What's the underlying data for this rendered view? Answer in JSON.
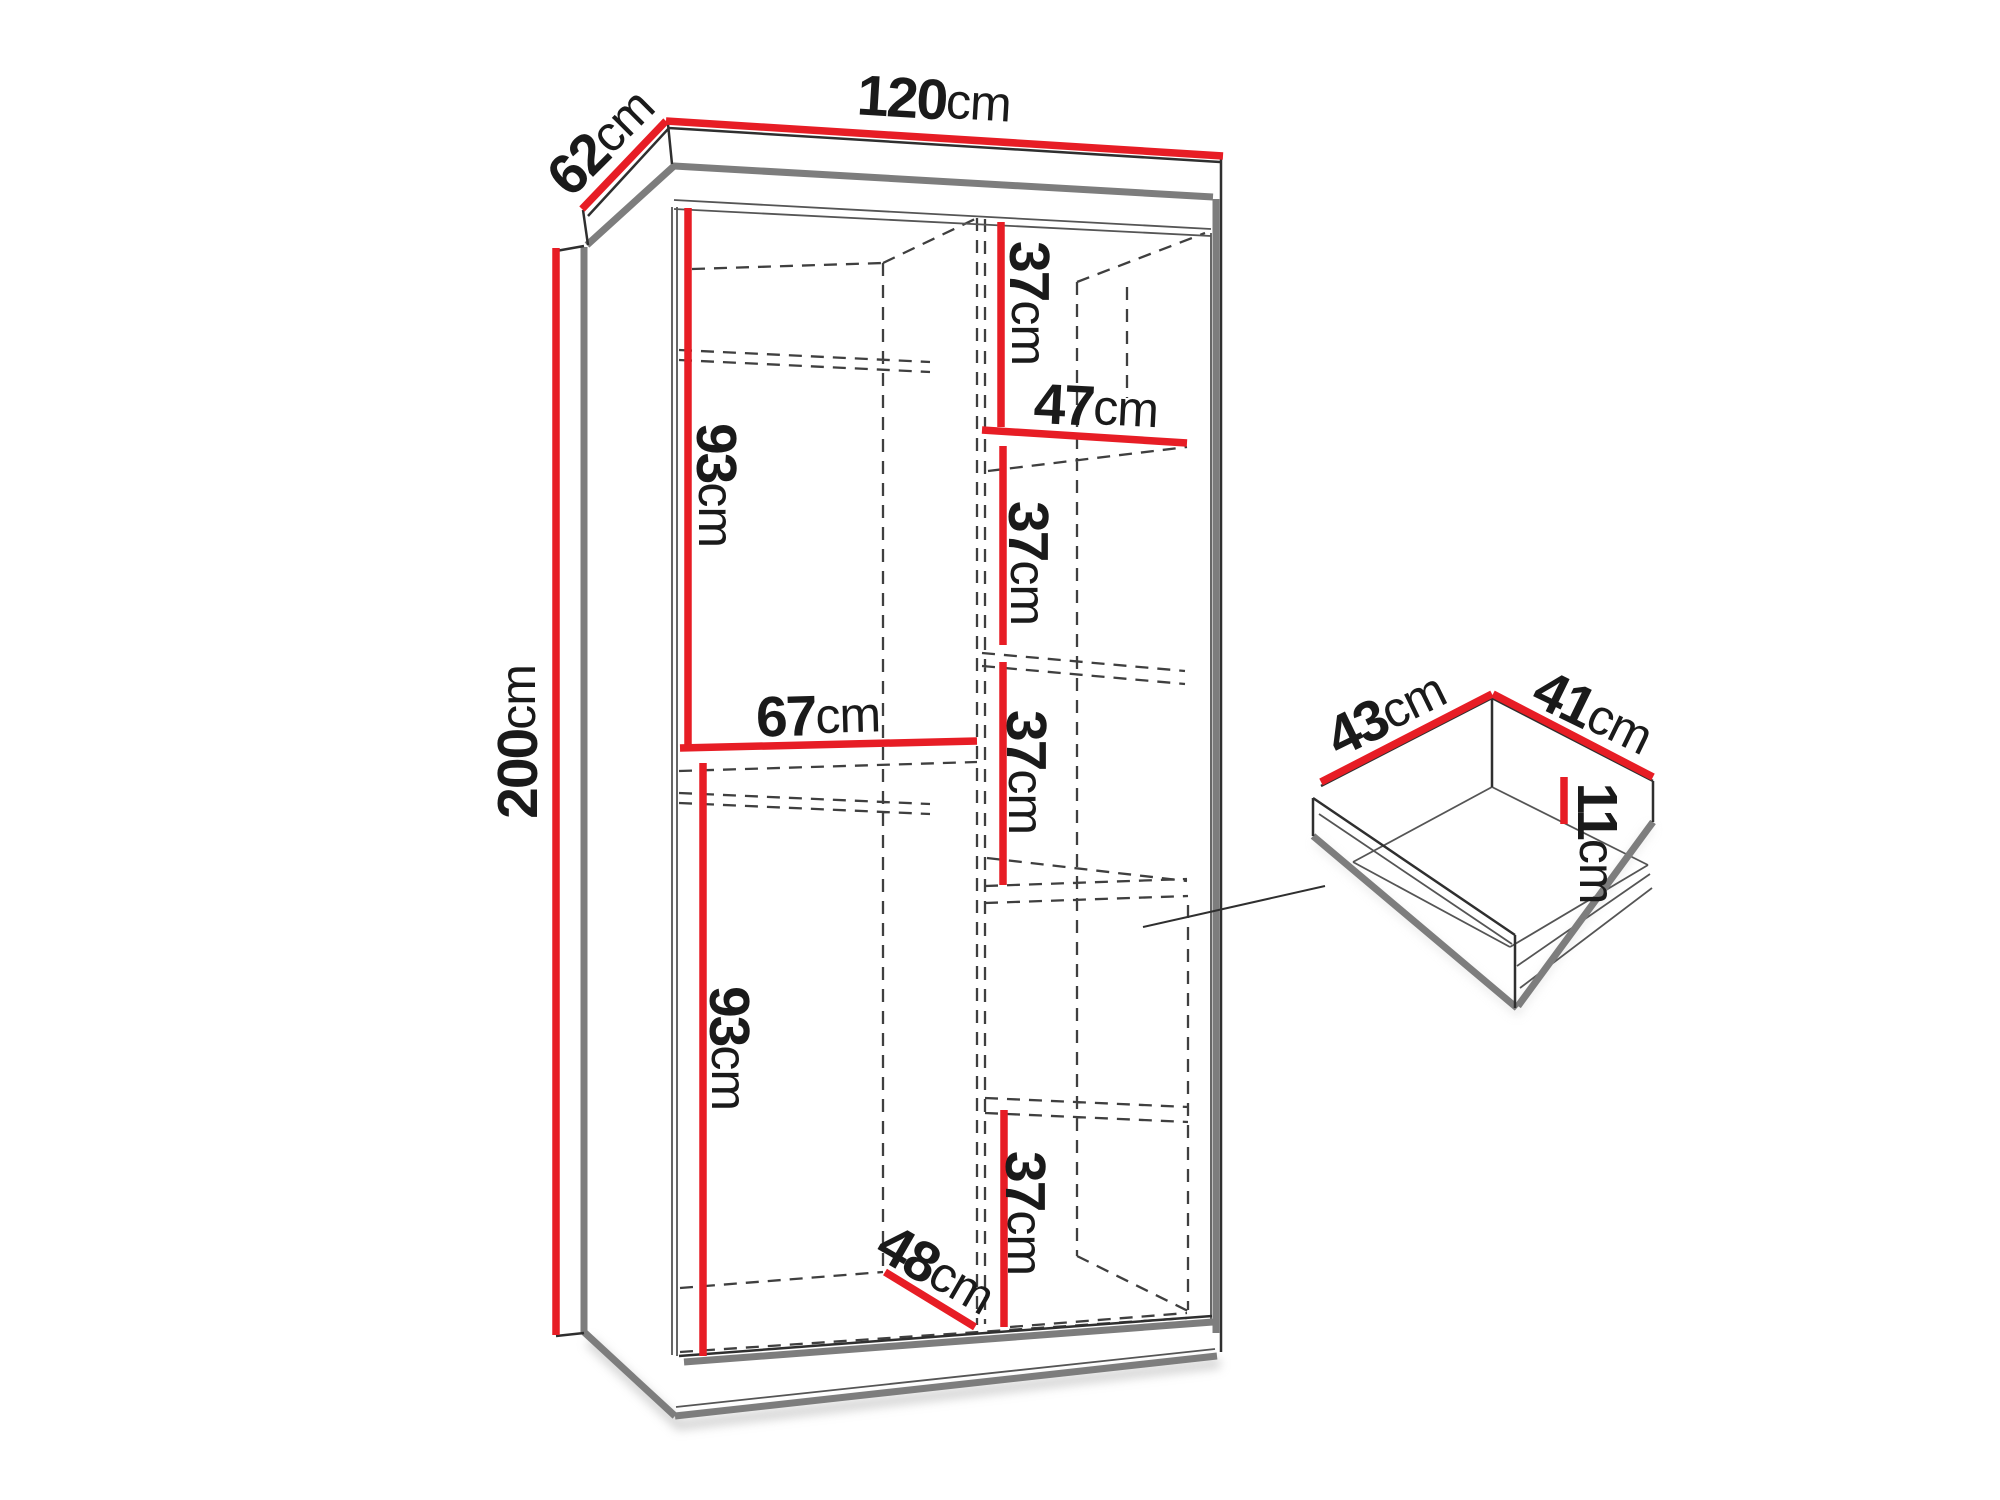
{
  "document": {
    "title": "Wardrobe dimension diagram",
    "background": "#ffffff"
  },
  "colors": {
    "dimension_line": "#e71d25",
    "outline_dark": "#2f2f2f",
    "outline_gray": "#7d7d7d",
    "dashed_line": "#3f3f3f",
    "text": "#1a1a1a"
  },
  "wardrobe": {
    "overall": {
      "width": {
        "value": "120",
        "unit": "cm"
      },
      "depth": {
        "value": "62",
        "unit": "cm"
      },
      "height": {
        "value": "200",
        "unit": "cm"
      }
    },
    "left_side": {
      "upper_section_height": {
        "value": "93",
        "unit": "cm"
      },
      "middle_shelf_width": {
        "value": "67",
        "unit": "cm"
      },
      "lower_section_height": {
        "value": "93",
        "unit": "cm"
      },
      "bottom_depth": {
        "value": "48",
        "unit": "cm"
      }
    },
    "right_column": {
      "shelf_width": {
        "value": "47",
        "unit": "cm"
      },
      "section1_height": {
        "value": "37",
        "unit": "cm"
      },
      "section2_height": {
        "value": "37",
        "unit": "cm"
      },
      "section3_height": {
        "value": "37",
        "unit": "cm"
      },
      "section4_height": {
        "value": "37",
        "unit": "cm"
      }
    }
  },
  "drawer": {
    "depth": {
      "value": "43",
      "unit": "cm"
    },
    "width": {
      "value": "41",
      "unit": "cm"
    },
    "height": {
      "value": "11",
      "unit": "cm"
    }
  }
}
